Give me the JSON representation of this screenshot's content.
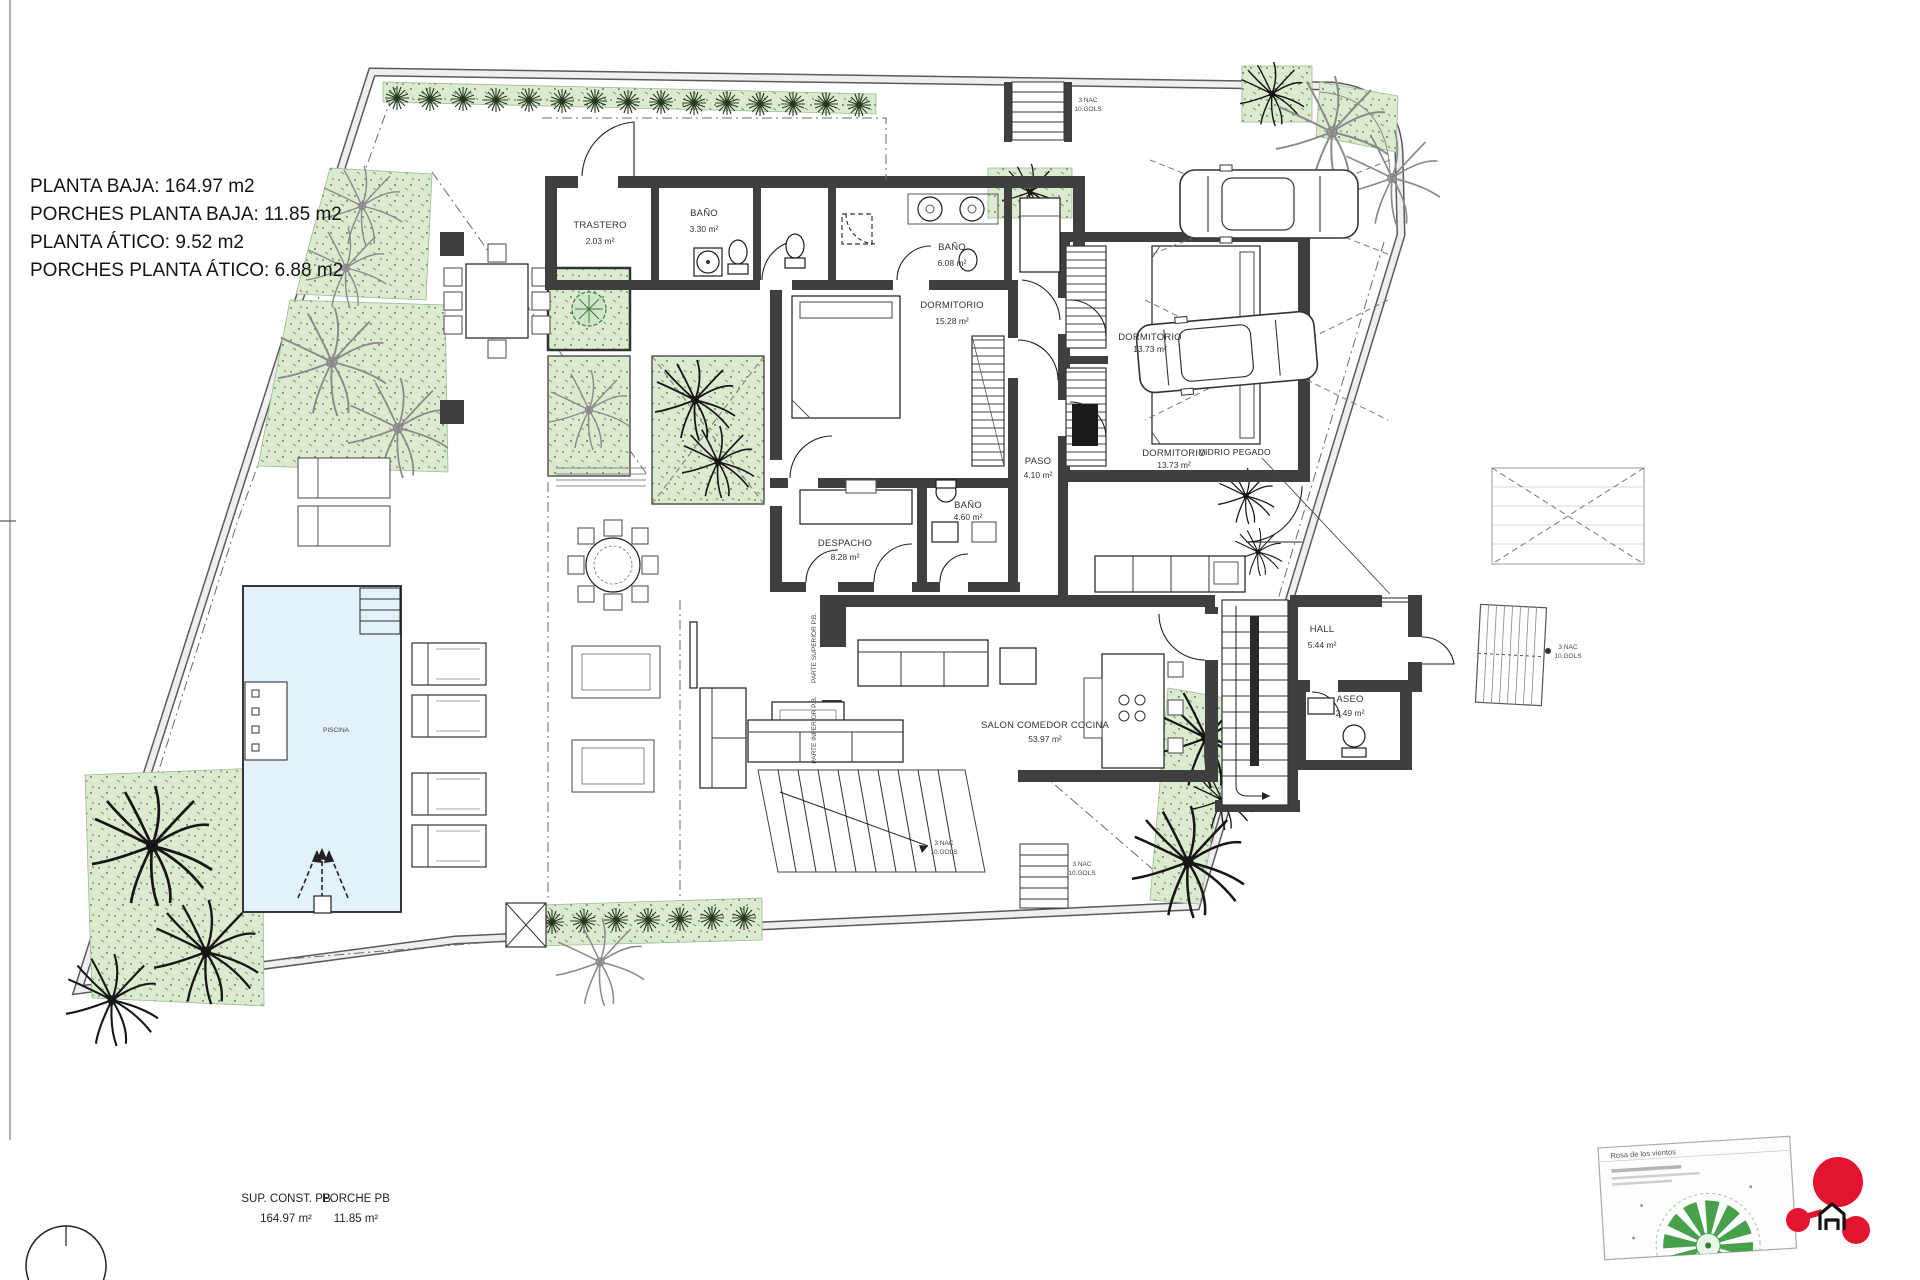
{
  "colors": {
    "wall": "#3f3f3f",
    "pool": "#e3f1fa",
    "hedge": "#dcead0",
    "logo_red": "#e4142e",
    "stipple_green": "#6f9960"
  },
  "summary": {
    "lines": [
      "PLANTA BAJA: 164.97 m2",
      "PORCHES PLANTA BAJA: 11.85 m2",
      "PLANTA ÁTICO: 9.52 m2",
      "PORCHES PLANTA ÁTICO: 6.88 m2"
    ]
  },
  "rooms": {
    "trastero": {
      "name": "TRASTERO",
      "area": "2.03 m²"
    },
    "bano_330": {
      "name": "BAÑO",
      "area": "3.30 m²"
    },
    "bano_608": {
      "name": "BAÑO",
      "area": "6.08 m²"
    },
    "dormitorio_1528": {
      "name": "DORMITORIO",
      "area": "15.28 m²"
    },
    "dormitorio_1373a": {
      "name": "DORMITORIO",
      "area": "13.73 m²"
    },
    "dormitorio_1373b": {
      "name": "DORMITORIO",
      "area": "13.73 m²"
    },
    "paso": {
      "name": "PASO",
      "area": "4.10 m²"
    },
    "despacho": {
      "name": "DESPACHO",
      "area": "8.28 m²"
    },
    "bano_460": {
      "name": "BAÑO",
      "area": "4.60 m²"
    },
    "salon": {
      "name": "SALON COMEDOR COCINA",
      "area": "53.97 m²"
    },
    "hall": {
      "name": "HALL",
      "area": "5.44 m²"
    },
    "aseo": {
      "name": "ASEO",
      "area": "2.49 m²"
    },
    "piscina": {
      "name": "PISCINA"
    }
  },
  "annotations": {
    "vidrio_pegado": "VIDRIO PEGADO",
    "stair_note_line1": "3 NAC",
    "stair_note_line2": "10.GOLS",
    "porch_note_a": "PARTE SUPERIOR P.B.",
    "porch_note_b": "PARTE INFERIOR P.B."
  },
  "footer": {
    "col1_label": "SUP. CONST. PB",
    "col1_value": "164.97 m²",
    "col2_label": "PORCHE PB",
    "col2_value": "11.85 m²"
  },
  "titleblock": {
    "title": "Rosa de los vientos"
  }
}
